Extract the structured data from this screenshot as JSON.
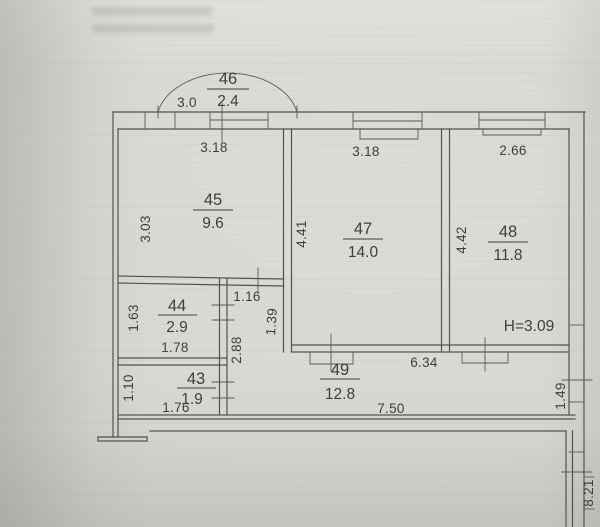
{
  "rooms": {
    "balcony": {
      "number": "46",
      "area": "2.4"
    },
    "r45": {
      "number": "45",
      "area": "9.6"
    },
    "r47": {
      "number": "47",
      "area": "14.0"
    },
    "r48": {
      "number": "48",
      "area": "11.8"
    },
    "r44": {
      "number": "44",
      "area": "2.9"
    },
    "r43": {
      "number": "43",
      "area": "1.9"
    },
    "r49": {
      "number": "49",
      "area": "12.8"
    }
  },
  "dimensions": {
    "balcony_width": "3.0",
    "r45_width": "3.18",
    "r45_depth": "3.03",
    "r47_width": "3.18",
    "r47_depth": "4.41",
    "r48_width": "2.66",
    "r48_depth": "4.42",
    "r44_width": "1.78",
    "r44_depth": "1.63",
    "r43_width": "1.76",
    "r43_depth": "1.10",
    "niche_width": "1.16",
    "niche_depth": "1.39",
    "hall_depth": "2.88",
    "hall_width_upper": "6.34",
    "hall_width_lower": "7.50",
    "right_offset": "1.49",
    "building_depth": "8.21"
  },
  "annotations": {
    "ceiling_height": "H=3.09"
  }
}
